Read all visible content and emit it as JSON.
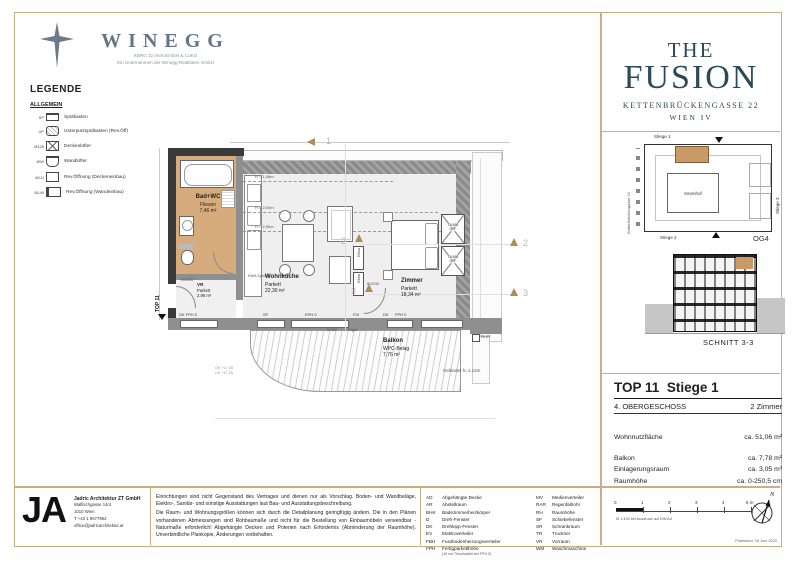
{
  "brand": {
    "name": "WINEGG",
    "subtitle1": "KBRG 22 ImmoGmbH & CoKG",
    "subtitle2": "Ein Unternehmen der Winegg Realitäten GmbH"
  },
  "project": {
    "line1": "THE",
    "line2": "FUSION",
    "address": "KETTENBRÜCKENGASSE 22",
    "city": "WIEN IV"
  },
  "legend": {
    "title": "LEGENDE",
    "section": "ALLGEMEIN",
    "items": [
      {
        "abbr": "SP",
        "label": "Spülkasten"
      },
      {
        "abbr": "UP",
        "label": "Unterputzspülkasten (Rev.Öff)"
      },
      {
        "abbr": "Ø125",
        "label": "Deckenlüfter"
      },
      {
        "abbr": "Ø90",
        "label": "Wandlüfter"
      },
      {
        "abbr": "60-D",
        "label": "Rev.Öffnung (Deckeneinbau)"
      },
      {
        "abbr": "60-W",
        "label": "Rev.Öffnung (Wandeinbau)"
      }
    ]
  },
  "plan": {
    "rooms": {
      "bad": {
        "name": "Bad+WC",
        "floor": "Fliesen",
        "area": "7,46 m²"
      },
      "vr": {
        "name": "VR",
        "floor": "Parkett",
        "area": "2,96 m²"
      },
      "wohnkueche": {
        "name": "Wohnküche",
        "floor": "Parkett",
        "area": "22,30 m²"
      },
      "zimmer": {
        "name": "Zimmer",
        "floor": "Parkett",
        "area": "18,34 m²"
      },
      "balkon": {
        "name": "Balkon",
        "floor": "WPC-Belag",
        "area": "7,76 m²"
      }
    },
    "entry": "TOP 11",
    "railing": "Geländer h=1,12m",
    "rar": "RAR",
    "rigol": "Rigol",
    "drain": "50/50",
    "kwa": "KWA System",
    "klima": "Klima",
    "wardrobe": {
      "size": "74/160",
      "note": "OFF"
    },
    "heights": [
      "H = 1,08m",
      "H = 2,00m",
      "H = 2,50m"
    ],
    "door1": "90/230",
    "door2": "80/230",
    "windows": [
      "DK FPH 0",
      "SF",
      "EPH 0",
      "FIX",
      "DK",
      "FPH 0"
    ],
    "markers": [
      "1",
      "2",
      "3"
    ],
    "levels": [
      "OK +17,35",
      "UK +17,25"
    ]
  },
  "siteplan": {
    "street": "Kettenbrückengasse 22",
    "stiege1": "Stiege 1",
    "stiege2": "Stiege 2",
    "stiege3": "Stiege 3",
    "courtyard": "Innenhof",
    "floor_tag": "OG4"
  },
  "schnitt": {
    "label": "SCHNITT 3-3"
  },
  "unit": {
    "top": "TOP 11",
    "stiege": "Stiege 1",
    "floor": "4. OBERGESCHOSS",
    "rooms": "2 Zimmer",
    "area_rows": [
      {
        "label": "Wohnnutzfläche",
        "value": "ca. 51,06 m²"
      },
      {
        "label": "Balkon",
        "value": "ca. 7,78 m²"
      },
      {
        "label": "Einlagerungsraum",
        "value": "ca. 3,05 m³"
      },
      {
        "label": "Raumhöhe",
        "value": "ca. 0-250,5 cm"
      }
    ]
  },
  "footer": {
    "logo": "JA",
    "firm_name": "Jadric Architektur ZT GmbH",
    "firm_lines": [
      "Walfischgasse 14/4",
      "1010 Wien",
      "T +43 1 9577952",
      "office@jadricarchitektur.at"
    ],
    "disclaimer1": "Einrichtungen sind nicht Gegenstand des Vertrages und dienen nur als Vorschlag. Boden- und Wandbeläge, Elektro-, Sanitär- und sonstige Ausstattungen laut Bau- und Ausstattungsbeschreibung.",
    "disclaimer2": "Die Raum- und Wohnungsgrößen können sich durch die Detailplanung geringfügig ändern. Die in den Plänen vorhandenen Abmessungen sind Rohbaumaße und nicht für die Bestellung von Einbaumöbeln verwendbar - Naturmaße erforderlich! Abgehängte Decken und Poterien nach Erfordernis (Abminderung der Raumhöhe). Unverbindliche Plankopie, Änderungen vorbehalten.",
    "abbr_left": [
      {
        "abbr": "AD",
        "label": "Abgehängte Decke"
      },
      {
        "abbr": "AR",
        "label": "Abstellraum"
      },
      {
        "abbr": "BHK",
        "label": "Badezimmerheizkörper"
      },
      {
        "abbr": "D",
        "label": "Dreh-Fenster"
      },
      {
        "abbr": "DK",
        "label": "Drehkipp-Fenster"
      },
      {
        "abbr": "EV",
        "label": "Elektroverteiler"
      },
      {
        "abbr": "FBH",
        "label": "Fussbodenheizungsverteiler"
      },
      {
        "abbr": "FPH",
        "label": "Fertigparketthöhe"
      }
    ],
    "fph_note": "(±0 cm Türschwelle bei FPH 0)",
    "abbr_right": [
      {
        "abbr": "MV",
        "label": "Medienverteiler"
      },
      {
        "abbr": "RAR",
        "label": "Regenfallrohr"
      },
      {
        "abbr": "RH",
        "label": "Raumhöhe"
      },
      {
        "abbr": "SF",
        "label": "Schiebefenster"
      },
      {
        "abbr": "SR",
        "label": "Schrankraum"
      },
      {
        "abbr": "TR",
        "label": "Trockner"
      },
      {
        "abbr": "VR",
        "label": "Vorraum"
      },
      {
        "abbr": "WM",
        "label": "Waschmaschine"
      }
    ],
    "scale_ticks": [
      "0",
      "1",
      "2",
      "3",
      "4",
      "5 m"
    ],
    "scale_note": "M 1:100 bei Ausdruck auf DIN A4",
    "compass": "N",
    "planstand": "Planstand: 18 Juni 2020"
  },
  "colors": {
    "accent_tan": "#c9ae84",
    "unit_fill": "#d2a878",
    "fusion_teal": "#2b4a57",
    "wall_gray": "#8f8f8f"
  }
}
